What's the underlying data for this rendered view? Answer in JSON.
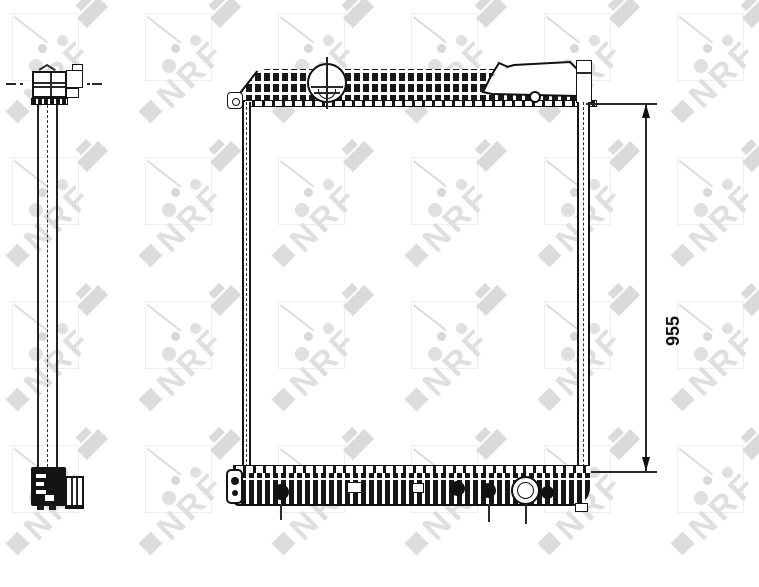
{
  "watermark": {
    "text": "NRF",
    "color": "#dfdfdf"
  },
  "dimensions": {
    "height_label": "955"
  },
  "colors": {
    "background": "#ffffff",
    "line": "#1a1a1a",
    "watermark": "#e5e5e5"
  }
}
